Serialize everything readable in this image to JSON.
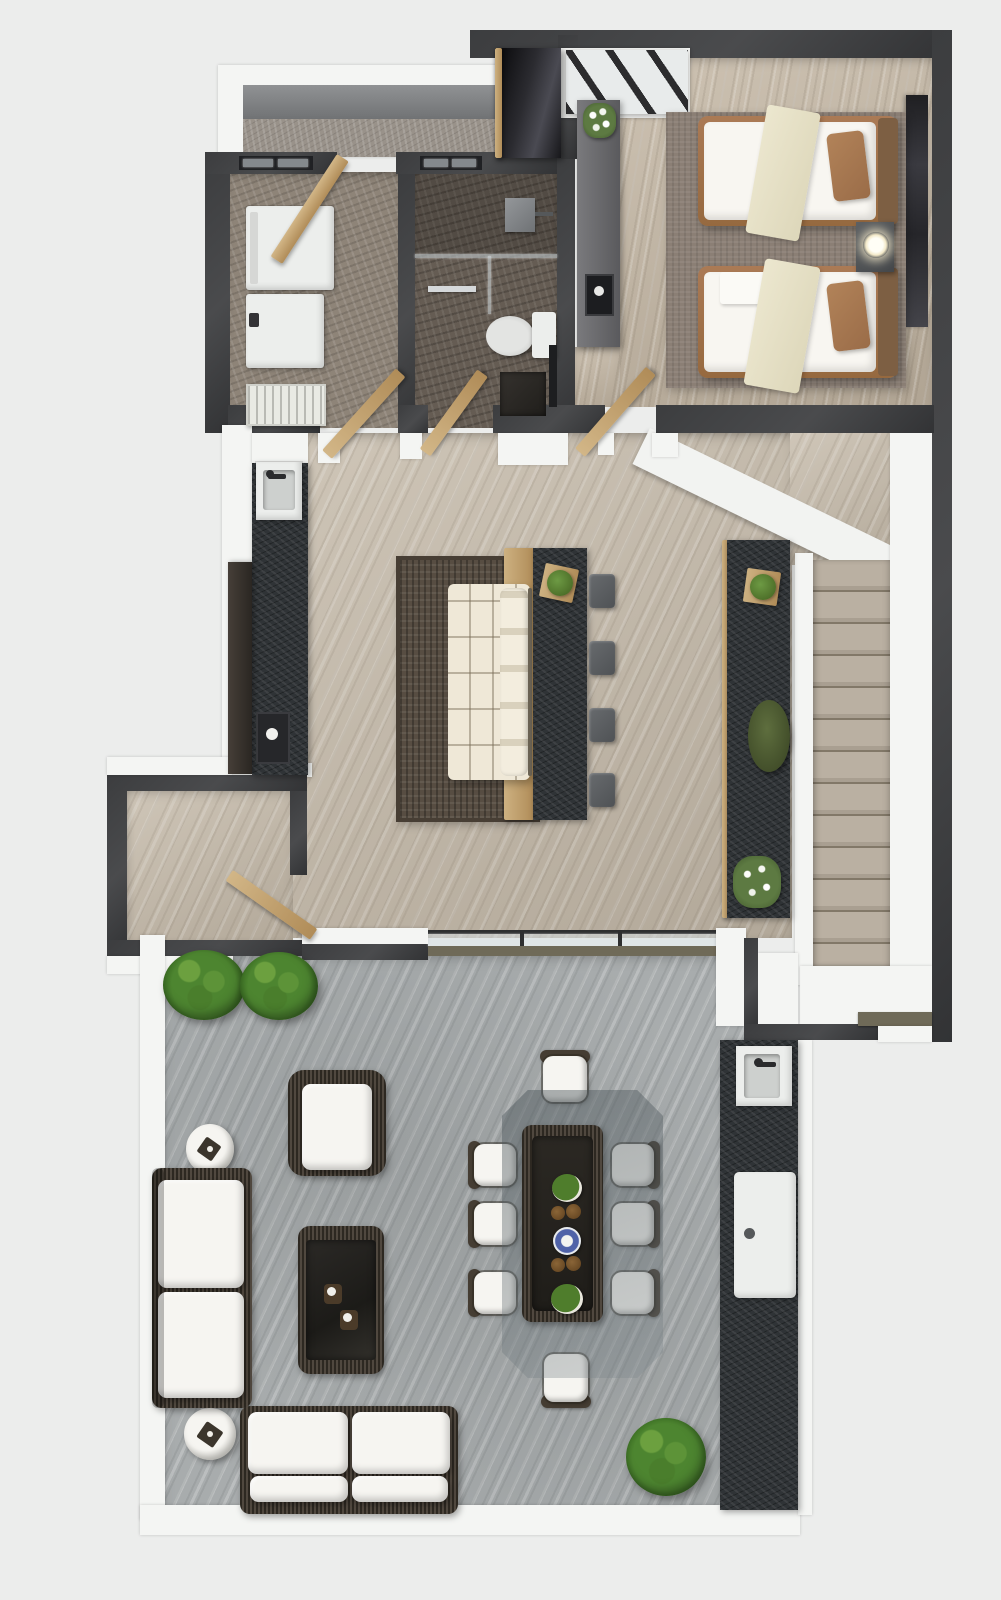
{
  "scene": {
    "type": "3d-rendered-top-down-floor-plan",
    "visible_text": [],
    "rooms": [
      "laundry-room",
      "bathroom",
      "bedroom",
      "back-patio",
      "living-room",
      "kitchenette",
      "entry-foyer",
      "staircase",
      "terrace",
      "outdoor-lounge",
      "outdoor-dining",
      "outdoor-kitchen"
    ]
  },
  "counts": {
    "beds": 2,
    "dining_chairs": 8,
    "bar_stools": 4,
    "outdoor_sofas": 2,
    "outdoor_armchairs": 1,
    "bushes": 3,
    "drum_side_tables": 2,
    "stair_steps": 13,
    "washer_dryer_units": 2,
    "sinks": 3
  },
  "colors": {
    "bg": "#ecedec",
    "wall": "#3c3d3f",
    "white": "#f4f5f3",
    "floorLiving": "#c3b9ab",
    "floorBedroom": "#c0b5a6",
    "floorBath": "#655c53",
    "floorUtility": "#8e8478",
    "floorPatio": "#99928a",
    "floorTerrace": "#a8acad",
    "rugBedroom": "#8b7f75",
    "rugLiving": "#574d42",
    "stone": "#2f3336",
    "wood": "#c3a472",
    "wicker": "#453d33",
    "cushion": "#f6f5f1",
    "mattress": "#f8f6f1",
    "bedFrame": "#a1724e",
    "pillow": "#a97b57",
    "throw": "#e9e4cb",
    "headboard": "#7d5f43",
    "stool": "#5c5f62",
    "glassCanopy": "#5f6a70",
    "plantDark": "#3c6323",
    "moss": "#4f5c35",
    "lamp": "#fff6dd",
    "appliance": "#eceeec",
    "toiletBowl": "#cfd0ce",
    "khaki": "#6f6a58",
    "closet": "#151518",
    "column": "#6e6e71",
    "artwork": "#27272b"
  }
}
